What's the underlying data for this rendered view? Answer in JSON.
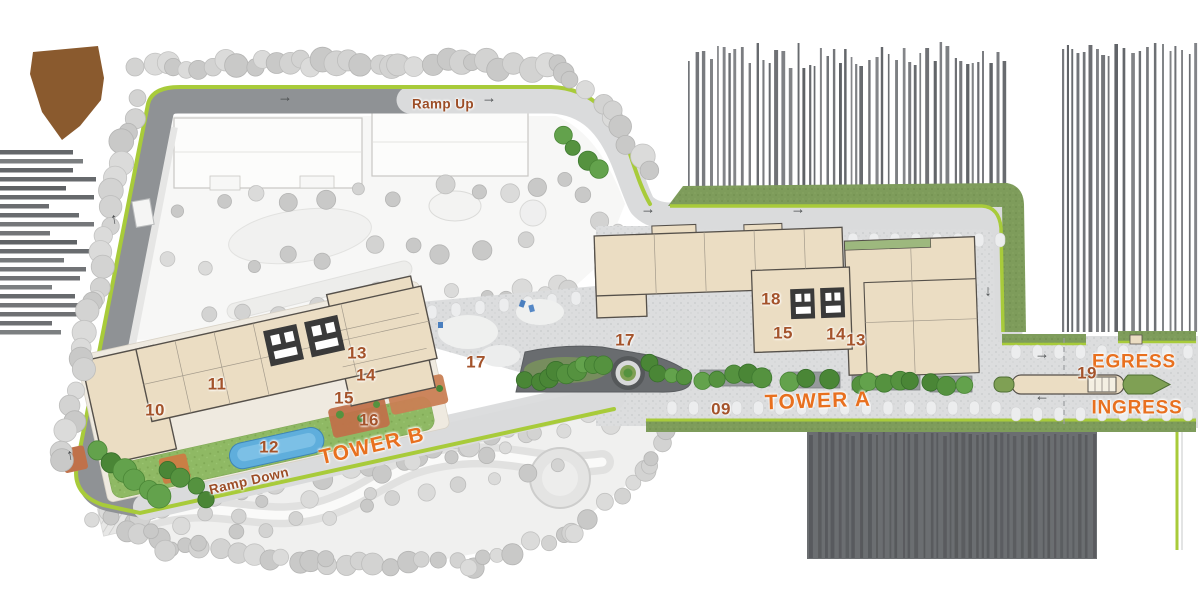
{
  "site_plan": {
    "labels": {
      "ramp_up": "Ramp Up",
      "ramp_down": "Ramp Down",
      "tower_a": "TOWER A",
      "tower_b": "TOWER B",
      "egress": "EGRESS",
      "ingress": "INGRESS"
    },
    "unit_markers": [
      {
        "label": "10"
      },
      {
        "label": "11"
      },
      {
        "label": "12"
      },
      {
        "label": "13"
      },
      {
        "label": "14"
      },
      {
        "label": "15"
      },
      {
        "label": "16"
      },
      {
        "label": "17"
      },
      {
        "label": "17"
      },
      {
        "label": "18"
      },
      {
        "label": "15"
      },
      {
        "label": "14"
      },
      {
        "label": "13"
      },
      {
        "label": "09"
      },
      {
        "label": "19"
      }
    ],
    "icons": {
      "arrow_right": "→",
      "arrow_left": "←",
      "arrow_up": "↑",
      "arrow_down": "↓"
    },
    "palette": {
      "tower_label_orange": "#E8701F",
      "marker_brown": "#A4532B",
      "ramp_label_brown": "#9C4D26",
      "road_dark": "#8F9295",
      "road_light": "#DADBDC",
      "green_edge_line": "#A8CB3A",
      "landscape_band_green": "#7E9C5B",
      "tree_green": "#4E8C3B",
      "lawn_green": "#8FB964",
      "building_beige": "#EBDDC3",
      "pool_blue": "#5FAEDC",
      "deck_terracotta": "#C0714A",
      "parcel_brown": "#8A5A2E",
      "hatch_gray": "#63666A",
      "muted_tree_gray": "#CCCCCC"
    }
  }
}
